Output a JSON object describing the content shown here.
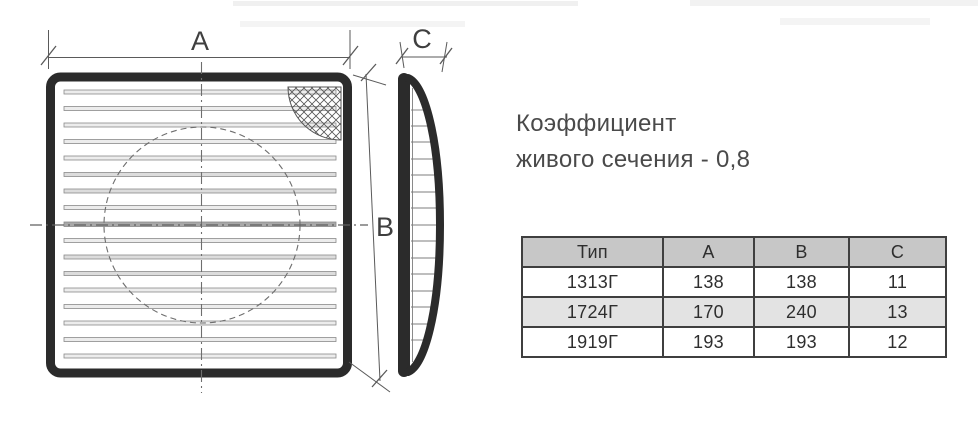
{
  "note": {
    "line1": "Коэффициент",
    "line2": "живого сечения - 0,8"
  },
  "drawing": {
    "labels": {
      "a": "A",
      "b": "B",
      "c": "C"
    }
  },
  "table": {
    "columns": [
      "Тип",
      "A",
      "B",
      "C"
    ],
    "rows": [
      [
        "1313Г",
        "138",
        "138",
        "11"
      ],
      [
        "1724Г",
        "170",
        "240",
        "13"
      ],
      [
        "1919Г",
        "193",
        "193",
        "12"
      ]
    ]
  },
  "colors": {
    "frame": "#2b2b2b",
    "thin_line": "#6e6e6e",
    "dimension": "#5a5a5a",
    "label_text": "#3f3f3f",
    "note_text": "#4a4a4a",
    "table_border": "#3f3f3f",
    "table_header_bg": "#c7c7c7",
    "table_alt_row_bg": "#e3e3e3"
  }
}
